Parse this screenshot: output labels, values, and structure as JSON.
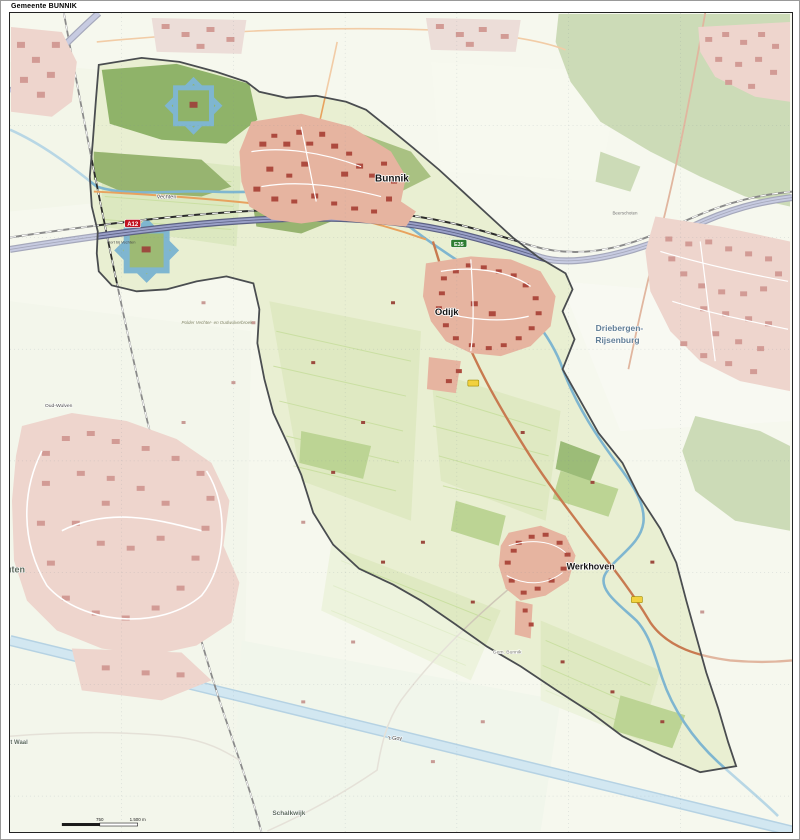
{
  "title": "Gemeente BUNNIK",
  "labels": {
    "bunnik": "Bunnik",
    "odijk": "Odijk",
    "werkhoven": "Werkhoven",
    "driebergen_line1": "Driebergen-",
    "driebergen_line2": "Rijsenburg",
    "vechten": "Vechten",
    "oud_wulven": "Oud-Wulven",
    "houten_partial": "uten",
    "schalkwijk": "Schalkwijk",
    "t_goy": "'t Goy",
    "t_waal": "'t Waal",
    "gem_bunnik": "Gem. Bunnik",
    "polder_vechter": "Polder Vechter- en Oudwulverbroek",
    "fort_vechten": "Fort bij Vechten",
    "beerschoten": "Beerschoten"
  },
  "road_shields": {
    "a12": "A12",
    "e35": "E35"
  },
  "scale_bar": {
    "mid_label": "750",
    "end_label": "1.500 m"
  },
  "colors": {
    "municipality_fill": "#e9efd2",
    "outside_mask": "#ffffff",
    "boundary": "#4a4d50",
    "water_line": "#7fb6d0",
    "canal_fill": "#aed3e6",
    "motorway": "#9aa0c8",
    "motorway_casing": "#5c6183",
    "main_road": "#c87a50",
    "secondary_road": "#e8a25e",
    "railway": "#2b2b2b",
    "town_fill": "#e6b4a0",
    "building": "#ad4a3e",
    "woods": "#a3bd7d",
    "woods_inside": "#8fb369",
    "pasture": "#dfe9c2",
    "orchard": "#bcd494",
    "shield_red": "#c1121f",
    "shield_green": "#2e7d32",
    "shield_yellow": "#f2d13e"
  }
}
